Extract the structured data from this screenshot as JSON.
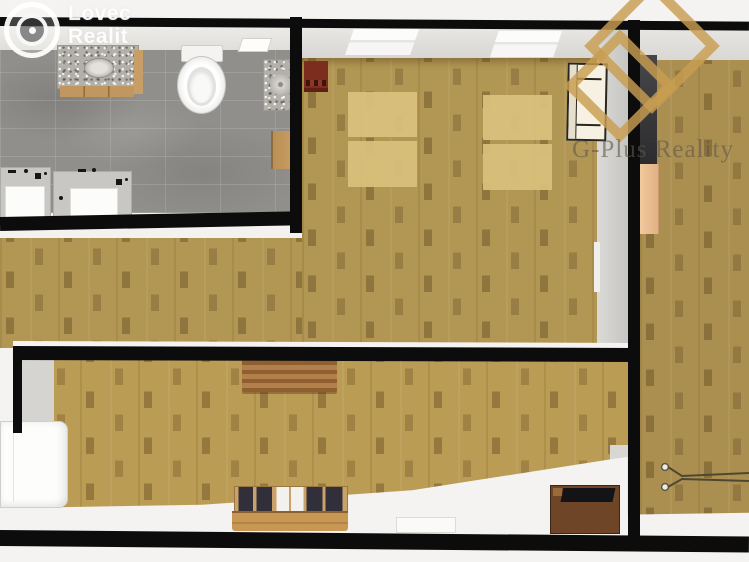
{
  "scene": {
    "type": "3d-floor-plan-top-view",
    "description": "Top-down 3D render of an apartment: bathroom top-left with gray tile, wood-floored bedroom and living areas, right room with radiator, watermarked by two realty brands"
  },
  "watermarks": {
    "agency": {
      "line1": "Lovec",
      "line2": "Realit"
    },
    "brand": {
      "text": "G-Plus Reality"
    }
  },
  "palette": {
    "background": "#f4f3f1",
    "wall": "#0c0c0c",
    "wood_floor": "#b29754",
    "wood_floor_bottom": "#bb9c55",
    "wood_floor_right": "#ab8f50",
    "tile_floor": "#918f8b",
    "mat": "#d9c07c",
    "door": "#f2c99e",
    "accent_gold": "#c89e4e",
    "brand_text": "#6f695d",
    "table_wood": "#a9763f",
    "sideboard_wood": "#caa269",
    "chest_wood": "#6f4527",
    "red_cabinet": "#7c2d1d"
  },
  "rooms": [
    {
      "name": "bathroom",
      "floor": "gray tile"
    },
    {
      "name": "bedroom-top",
      "floor": "wood parquet"
    },
    {
      "name": "living-area",
      "floor": "wood parquet"
    },
    {
      "name": "lower-room",
      "floor": "wood parquet"
    },
    {
      "name": "right-room",
      "floor": "wood parquet"
    }
  ],
  "furniture": [
    {
      "name": "vanity-sink",
      "room": "bathroom"
    },
    {
      "name": "toilet",
      "room": "bathroom"
    },
    {
      "name": "corner-sink",
      "room": "bathroom"
    },
    {
      "name": "wall-shelf",
      "room": "bathroom"
    },
    {
      "name": "storage-box",
      "room": "bathroom"
    },
    {
      "name": "washing-machine-1",
      "room": "bathroom"
    },
    {
      "name": "washing-machine-2",
      "room": "bathroom"
    },
    {
      "name": "red-cabinet",
      "room": "bedroom-top"
    },
    {
      "name": "floor-mat-pair-1",
      "room": "bedroom-top"
    },
    {
      "name": "floor-mat-pair-2",
      "room": "bedroom-top"
    },
    {
      "name": "display-cabinet",
      "room": "bedroom-top"
    },
    {
      "name": "window-1",
      "room": "bedroom-top"
    },
    {
      "name": "window-2",
      "room": "bedroom-top"
    },
    {
      "name": "coffee-table",
      "room": "lower-room"
    },
    {
      "name": "sideboard",
      "room": "lower-room"
    },
    {
      "name": "sofa",
      "room": "lower-room"
    },
    {
      "name": "storage-chest",
      "room": "lower-room"
    },
    {
      "name": "open-door",
      "room": "right-room"
    },
    {
      "name": "radiator",
      "room": "right-room"
    }
  ]
}
